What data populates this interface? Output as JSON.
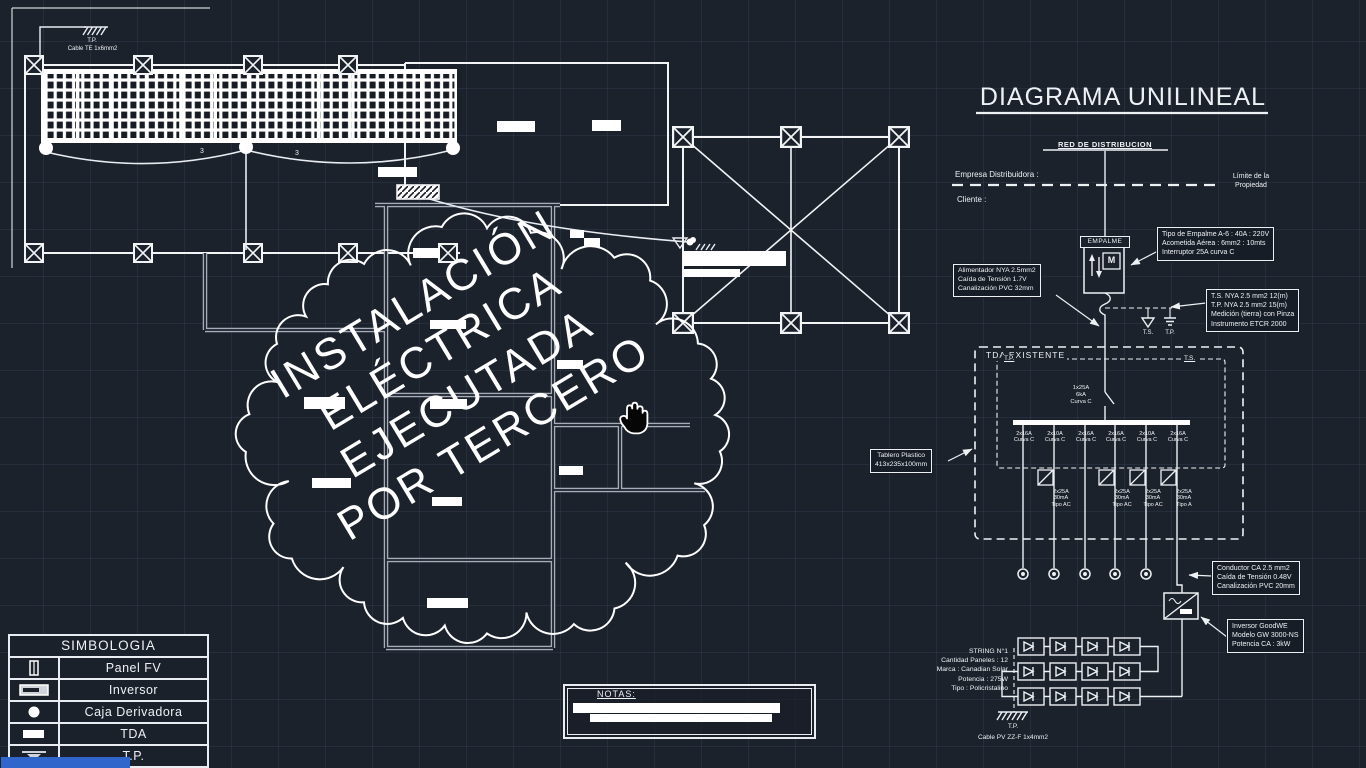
{
  "plan": {
    "tp_top": "T.P.",
    "cable_top": "Cable TE 1x6mm2",
    "span_label_1": "3",
    "span_label_2": "3"
  },
  "cloud": {
    "line1": "INSTALACIÓN",
    "line2": "ELÉCTRICA",
    "line3": "EJECUTADA",
    "line4": "POR TERCERO"
  },
  "unilineal": {
    "title": "DIAGRAMA UNILINEAL",
    "red_distribucion": "RED DE DISTRIBUCION",
    "empresa": "Empresa Distribuidora :",
    "cliente": "Cliente :",
    "limite_1": "Límite de la",
    "limite_2": "Propiedad",
    "empalme": "EMPALME",
    "meter": "M",
    "c_empalme": {
      "l1": "Tipo de Empalme A-6 : 40A : 220V",
      "l2": "Acometida Aérea : 6mm2 : 10mts",
      "l3": "Interruptor 25A curva C"
    },
    "c_alimentador": {
      "l1": "Alimentador NYA 2.5mm2",
      "l2": "Caída de Tensión 1.7V",
      "l3": "Canalización PVC 32mm"
    },
    "c_medicion": {
      "l1": "T.S. NYA 2.5 mm2 12(m)",
      "l2": "T.P. NYA 2.5 mm2 15(m)",
      "l3": "Medición (tierra) con Pinza",
      "l4": "Instrumento ETCR 2000"
    },
    "ts": "T.S.",
    "tp": "T.P.",
    "tda": {
      "title": "TDA EXISTENTE",
      "tp": "T.P.",
      "ts": "T.S.",
      "main": {
        "l1": "1x25A",
        "l2": "6kA",
        "l3": "Curva C"
      },
      "b1": {
        "l1": "2x16A",
        "l2": "Curva C"
      },
      "b2": {
        "l1": "2x10A",
        "l2": "Curva C"
      },
      "b3": {
        "l1": "2x16A",
        "l2": "Curva C"
      },
      "b4": {
        "l1": "2x16A",
        "l2": "Curva C"
      },
      "b5": {
        "l1": "2x10A",
        "l2": "Curva C"
      },
      "b6": {
        "l1": "2x16A",
        "l2": "Curva C"
      },
      "r1": {
        "l1": "2x25A",
        "l2": "30mA",
        "l3": "Tipo AC"
      },
      "r2": {
        "l1": "2x25A",
        "l2": "30mA",
        "l3": "Tipo AC"
      },
      "r3": {
        "l1": "2x25A",
        "l2": "30mA",
        "l3": "Tipo AC"
      },
      "r4": {
        "l1": "2x25A",
        "l2": "30mA",
        "l3": "Tipo A"
      }
    },
    "c_tablero": {
      "l1": "Tablero Plastico",
      "l2": "413x235x100mm"
    },
    "c_conductor": {
      "l1": "Conductor CA 2.5 mm2",
      "l2": "Caída de Tensión 0.48V",
      "l3": "Canalización PVC 20mm"
    },
    "c_inversor": {
      "l1": "Inversor GoodWE",
      "l2": "Modelo GW 3000-NS",
      "l3": "Potencia CA : 3kW"
    },
    "string": {
      "l1": "STRING N°1",
      "l2": "Cantidad Paneles : 12",
      "l3": "Marca : Canadian Solar",
      "l4": "Potencia : 275W",
      "l5": "Tipo : Policristalino"
    },
    "string_tp": "T.P.",
    "string_cable": "Cable PV ZZ-F 1x4mm2"
  },
  "simbologia": {
    "title": "SIMBOLOGIA",
    "rows": [
      {
        "label": "Panel FV"
      },
      {
        "label": "Inversor"
      },
      {
        "label": "Caja Derivadora"
      },
      {
        "label": "TDA"
      },
      {
        "label": "T.P."
      }
    ]
  },
  "notas": {
    "title": "NOTAS:"
  }
}
